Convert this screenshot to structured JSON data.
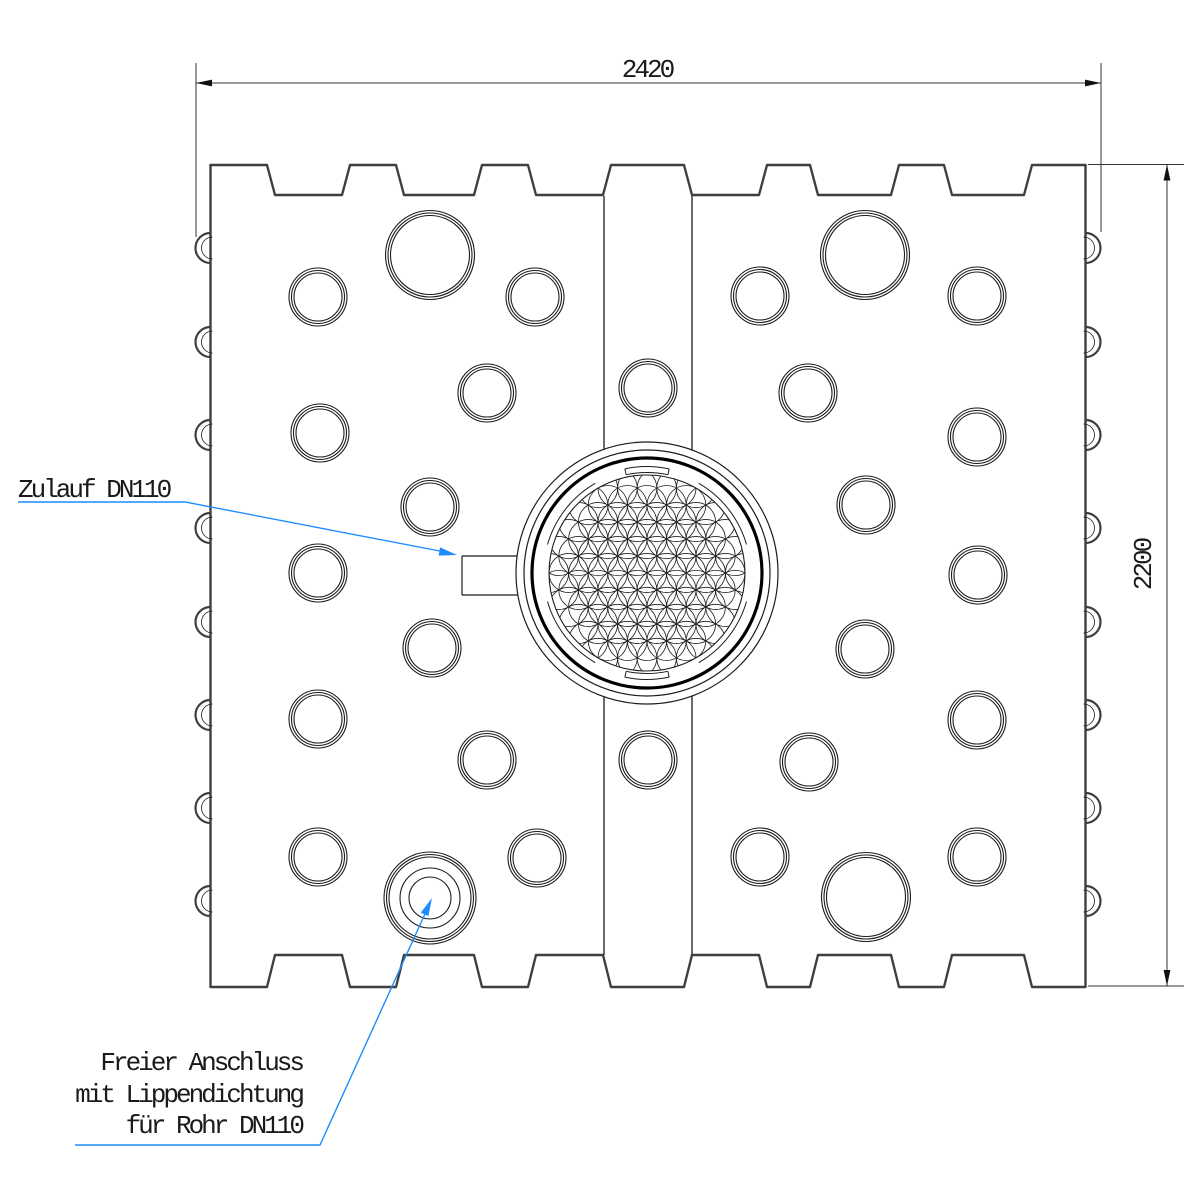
{
  "meta": {
    "drawing_type": "technical-cad-top-view",
    "bg_color": "#ffffff",
    "line_color": "#3f3f3f",
    "thin_line_color": "#1c1c1c",
    "accent_color": "#1e8cff"
  },
  "dimensions": {
    "width": {
      "value": "2420",
      "line_y": 83,
      "x1": 196,
      "x2": 1101,
      "ext_top": 63,
      "ext_bot_left": 237,
      "ext_bot_right": 232,
      "text_x": 647,
      "text_y": 77
    },
    "height": {
      "value": "2200",
      "line_x": 1167,
      "y1": 164.5,
      "y2": 986,
      "ext_left": 1088,
      "ext_right": 1184,
      "text_x": 1151,
      "text_y": 565
    }
  },
  "annotations": {
    "inlet": {
      "label": "Zulauf DN110",
      "text_x": 18,
      "text_y": 497,
      "leader": [
        [
          18,
          502
        ],
        [
          185,
          502
        ],
        [
          450,
          553
        ]
      ],
      "tip": [
        457,
        555
      ]
    },
    "connection": {
      "lines": [
        "Freier Anschluss",
        "mit Lippendichtung",
        "für Rohr DN110"
      ],
      "text_right_x": 302,
      "baselines": [
        1070,
        1102,
        1133
      ],
      "leader": [
        [
          75,
          1145
        ],
        [
          320,
          1145
        ],
        [
          429,
          905
        ]
      ],
      "tip": [
        432,
        898
      ]
    }
  },
  "drawing": {
    "body": {
      "left": 210.5,
      "right": 1085.5,
      "top_tab_y": 165,
      "top_valley_y": 195,
      "bottom_tab_y": 955,
      "bottom_valley_y": 987,
      "slant": 8,
      "top_tabs": [
        [
          210.5,
          267
        ],
        [
          350,
          396
        ],
        [
          482,
          528
        ],
        [
          611,
          684
        ],
        [
          767,
          810
        ],
        [
          899,
          944
        ],
        [
          1032,
          1085.5
        ]
      ]
    },
    "bumps": {
      "ys": [
        248,
        342,
        435,
        528,
        622,
        715,
        808,
        901
      ],
      "radius": 15
    },
    "band": {
      "x1": 604,
      "x2": 692,
      "y_top": 196,
      "y_bottom": 955,
      "gap1": [
        449,
        697
      ],
      "gap2": [
        451,
        695
      ],
      "circles": [
        [
          648,
          388
        ],
        [
          648,
          760
        ]
      ]
    },
    "holes_small": [
      [
        318,
        297
      ],
      [
        535,
        297
      ],
      [
        487,
        393
      ],
      [
        320,
        433
      ],
      [
        430,
        507
      ],
      [
        318,
        573
      ],
      [
        432,
        648
      ],
      [
        318,
        719
      ],
      [
        487,
        760
      ],
      [
        318,
        857
      ],
      [
        537,
        858
      ],
      [
        760,
        296
      ],
      [
        977,
        296
      ],
      [
        808,
        393
      ],
      [
        977,
        437
      ],
      [
        866,
        505
      ],
      [
        978,
        575
      ],
      [
        865,
        649
      ],
      [
        977,
        720
      ],
      [
        809,
        762
      ],
      [
        760,
        857
      ],
      [
        977,
        857
      ]
    ],
    "small_radii": [
      29,
      26.5,
      24
    ],
    "holes_large": [
      [
        430,
        255
      ],
      [
        865,
        255
      ],
      [
        866,
        897
      ]
    ],
    "large_radii": [
      44.5,
      42,
      39.5
    ],
    "connection_port": {
      "cx": 430,
      "cy": 898,
      "outer": [
        46,
        43.5,
        41
      ],
      "inner": [
        30,
        21
      ]
    },
    "inlet_port": {
      "x": 462,
      "y1": 556,
      "y2": 595
    },
    "manhole": {
      "cx": 647,
      "cy": 573,
      "rings": [
        131,
        123
      ],
      "thick_ring": 115,
      "flower_r": 98,
      "petal_r": 19.6,
      "side_arcs": {
        "r": 103.5,
        "spans": [
          [
            16,
            60
          ],
          [
            120,
            164
          ],
          [
            196,
            240
          ],
          [
            300,
            344
          ]
        ]
      },
      "slots": {
        "r1": 100.5,
        "r2": 106.5,
        "spans": [
          [
            78,
            102
          ],
          [
            258,
            282
          ]
        ]
      }
    }
  }
}
